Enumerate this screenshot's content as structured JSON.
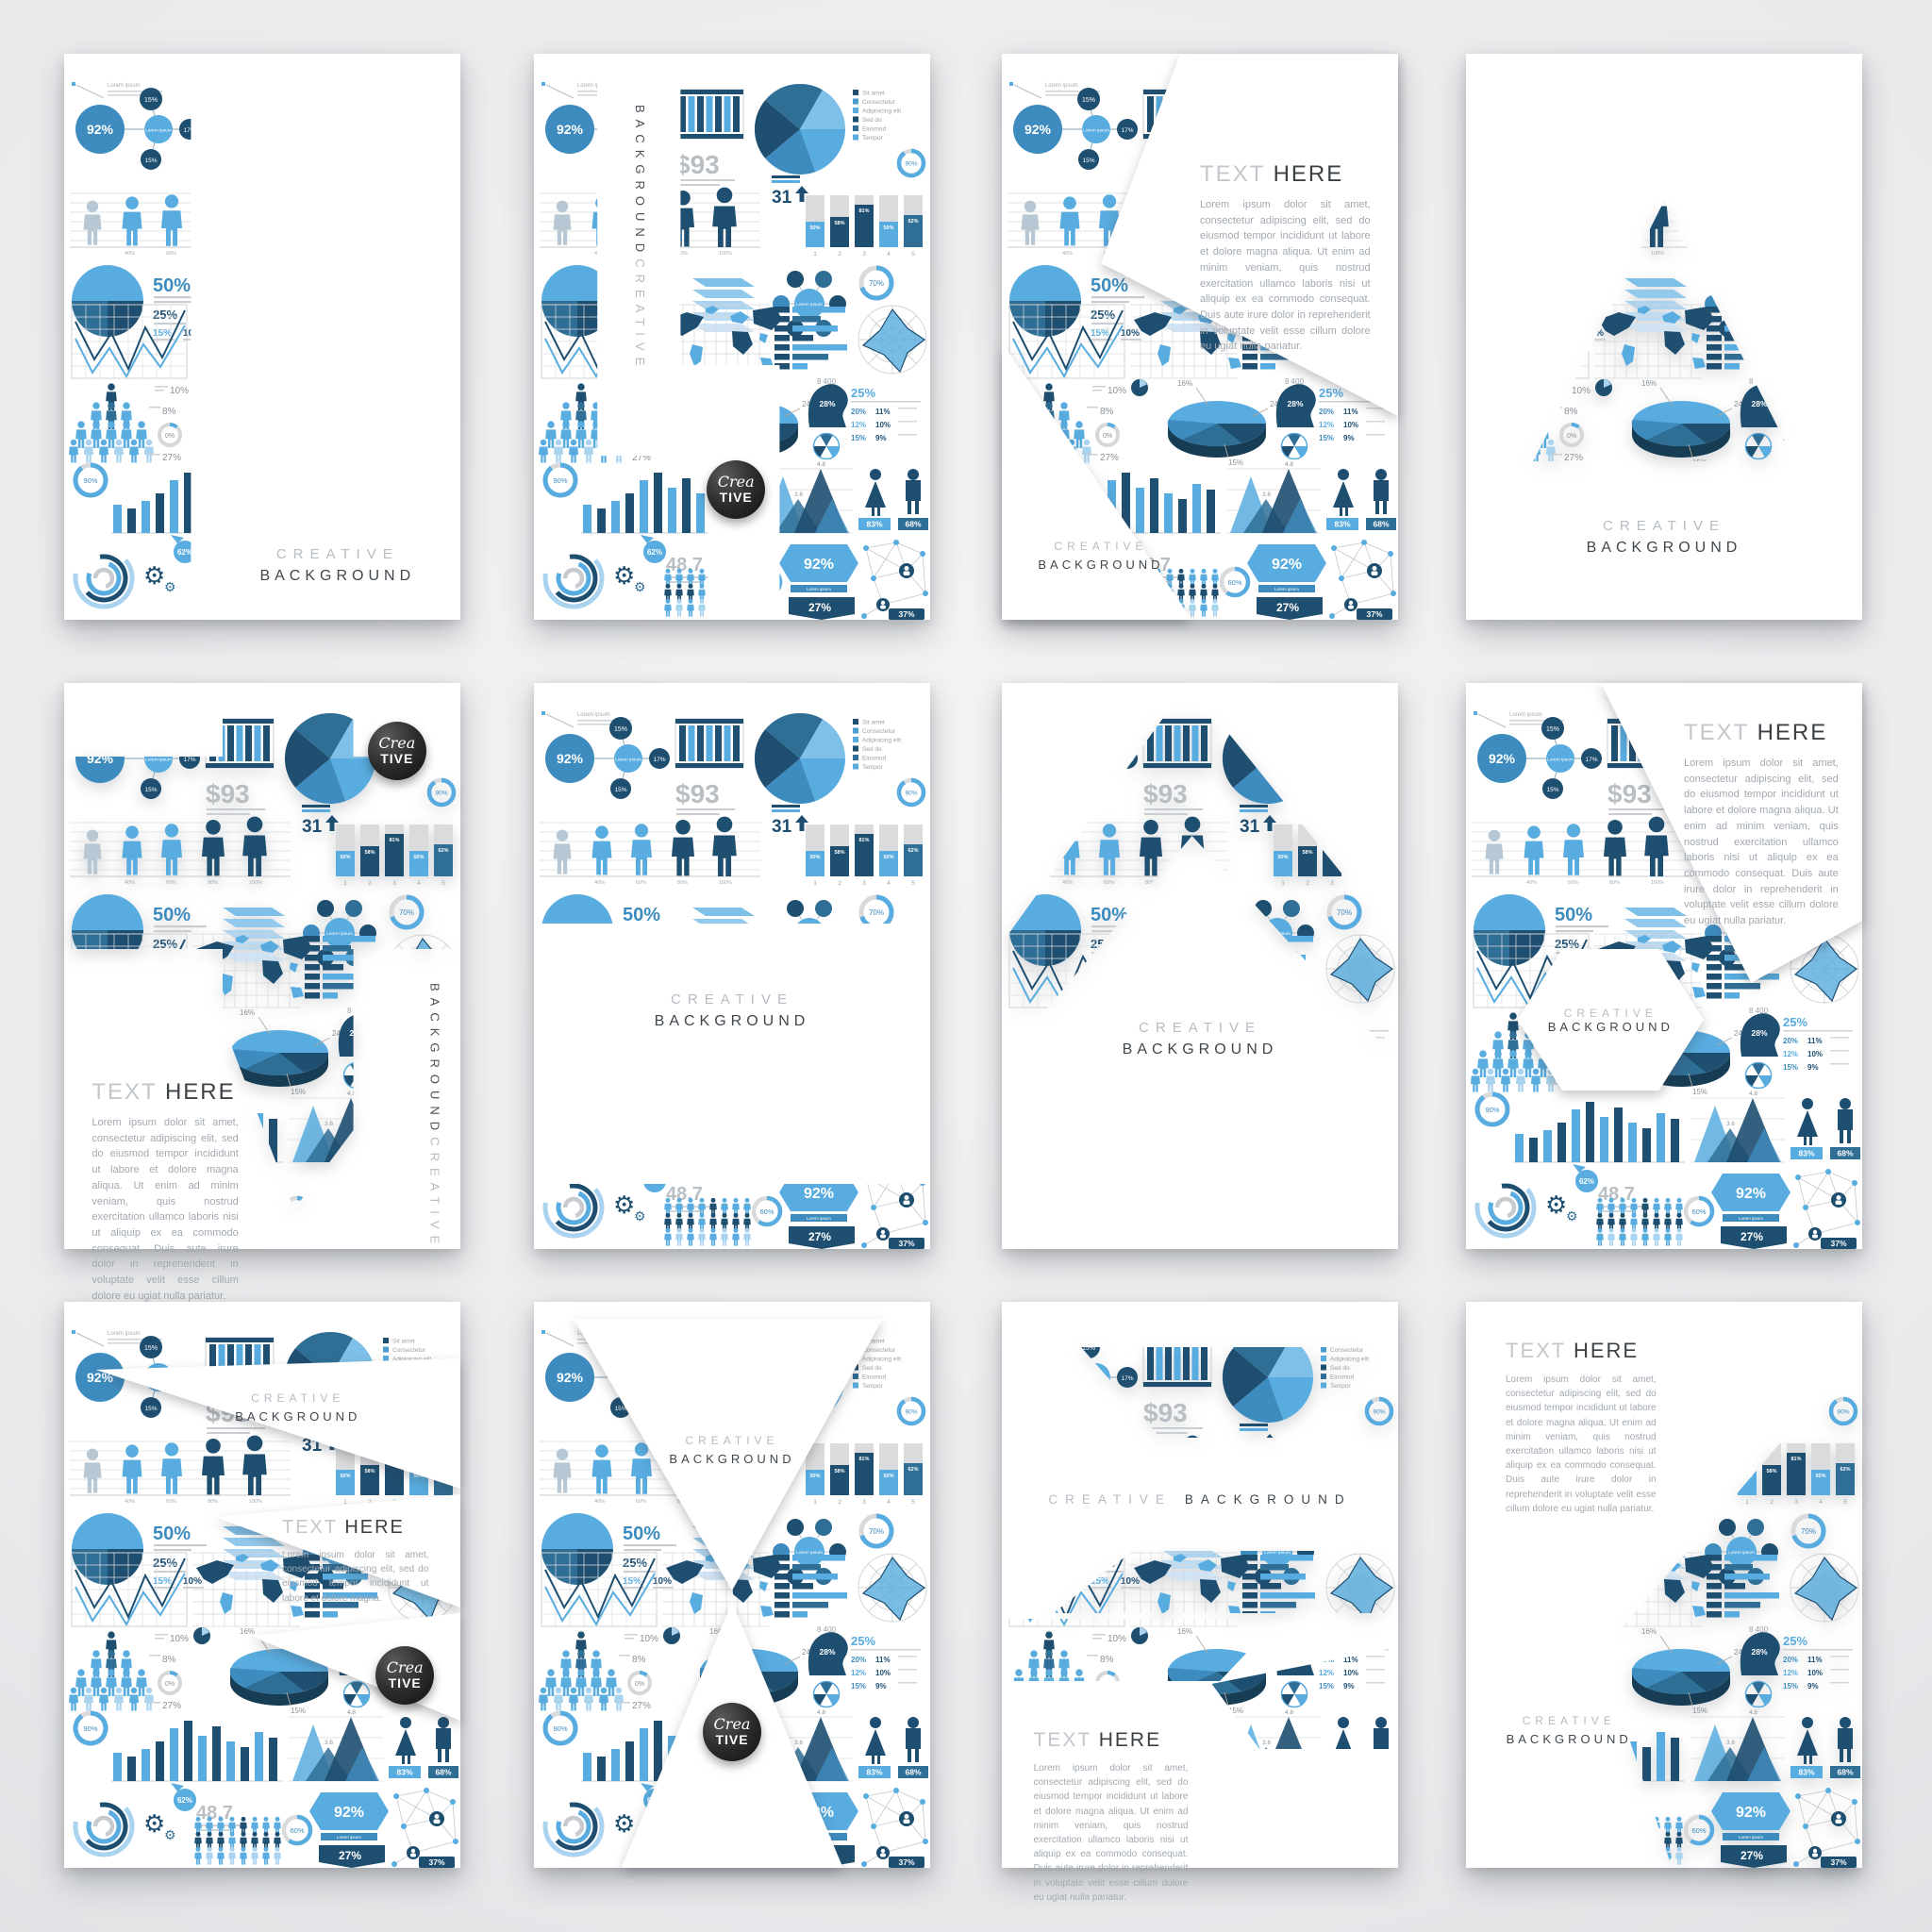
{
  "page": {
    "background": "#E8E9EB",
    "description": "Set of 12 infographic brochure templates, blue style"
  },
  "palette": {
    "light_blue": "#58ACDF",
    "mid_blue": "#3E8CBF",
    "navy": "#1E4E70",
    "steel_blue": "#2F6E95",
    "pale_blue": "#A9D3EF",
    "gray": "#D6D8DA",
    "text_gray": "#9BA3AB",
    "dark_text": "#3E4449",
    "badge_black": "#1E1E1E",
    "page_white": "#FFFFFF"
  },
  "brand": {
    "line1": "CREATIVE",
    "line2": "BACKGROUND"
  },
  "badge": {
    "top": "Crea",
    "bottom": "TIVE"
  },
  "text_block": {
    "heading_light": "TEXT",
    "heading_dark": "HERE",
    "paragraph": "Lorem ipsum dolor sit amet, consectetur adipiscing elit, sed do eiusmod tempor incididunt ut labore et dolore magna aliqua. Ut enim ad minim veniam, quis nostrud exercitation ullamco laboris nisi ut aliquip ex ea commodo consequat. Duis aute irure dolor in reprehenderit in voluptate velit esse cillum dolore eu ugiat nulla pariatur.",
    "paragraph_short": "Lorem ipsum dolor sit amet, consectetur adipiscing elit, sed do eiusmod tempor incididunt ut labore et dolore magna."
  },
  "collage": {
    "conn_main": "92%",
    "conn_top": "15%",
    "conn_right": "17%",
    "conn_bottom": "15%",
    "small_label": "Lorem ipsum",
    "amount": "$93",
    "legend": [
      "Sit amet",
      "Consectetur",
      "Adipisicing elit",
      "Sed do",
      "Eiusmod",
      "Tempor"
    ],
    "big31": "31",
    "col_pcts": [
      "50%",
      "58%",
      "81%",
      "50%",
      "62%"
    ],
    "col_nums": [
      "1",
      "2",
      "3",
      "4",
      "5"
    ],
    "people_ticks": [
      "40%",
      "60%",
      "80%",
      "100%"
    ],
    "pct50": "50%",
    "pct25": "25%",
    "pct15": "15%",
    "pct10": "10%",
    "pct70": "70%",
    "n8400": "8 400",
    "c10": "10%",
    "c8": "8%",
    "c0": "0%",
    "c27": "27%",
    "c16": "16%",
    "c24": "24%",
    "c15b": "15%",
    "head28": "28%",
    "t25": "25%",
    "table": [
      [
        "20%",
        "11%"
      ],
      [
        "12%",
        "10%"
      ],
      [
        "15%",
        "9%"
      ]
    ],
    "pct90": "90%",
    "peak48": "4.8",
    "peak36": "3.6",
    "pct62": "62%",
    "n487": "48.7",
    "pct60": "60%",
    "banner92": "92%",
    "banner27": "27%",
    "pct83": "83%",
    "pct68": "68%",
    "pct37": "37%"
  },
  "cards": [
    {
      "label": "left vertical collage strip, title bottom right"
    },
    {
      "label": "stepped collage panels, vertical title, black badge"
    },
    {
      "label": "diagonal arrow cutout with text block, title bottom left"
    },
    {
      "label": "triangle collage window, title below"
    },
    {
      "label": "cross arrow collage, badge top right, text block bottom left, vertical title right"
    },
    {
      "label": "top collage band and footer strip, centered title"
    },
    {
      "label": "chevron collage band, centered title"
    },
    {
      "label": "collage with top-right text panel and white hexagon title window"
    },
    {
      "label": "collage with three white wedges, title, short text, badge"
    },
    {
      "label": "hourglass collage, title top, badge bottom"
    },
    {
      "label": "diagonal collage strips, single-line title, text block bottom left"
    },
    {
      "label": "corner collage wedge, text block top left, title bottom left"
    }
  ]
}
